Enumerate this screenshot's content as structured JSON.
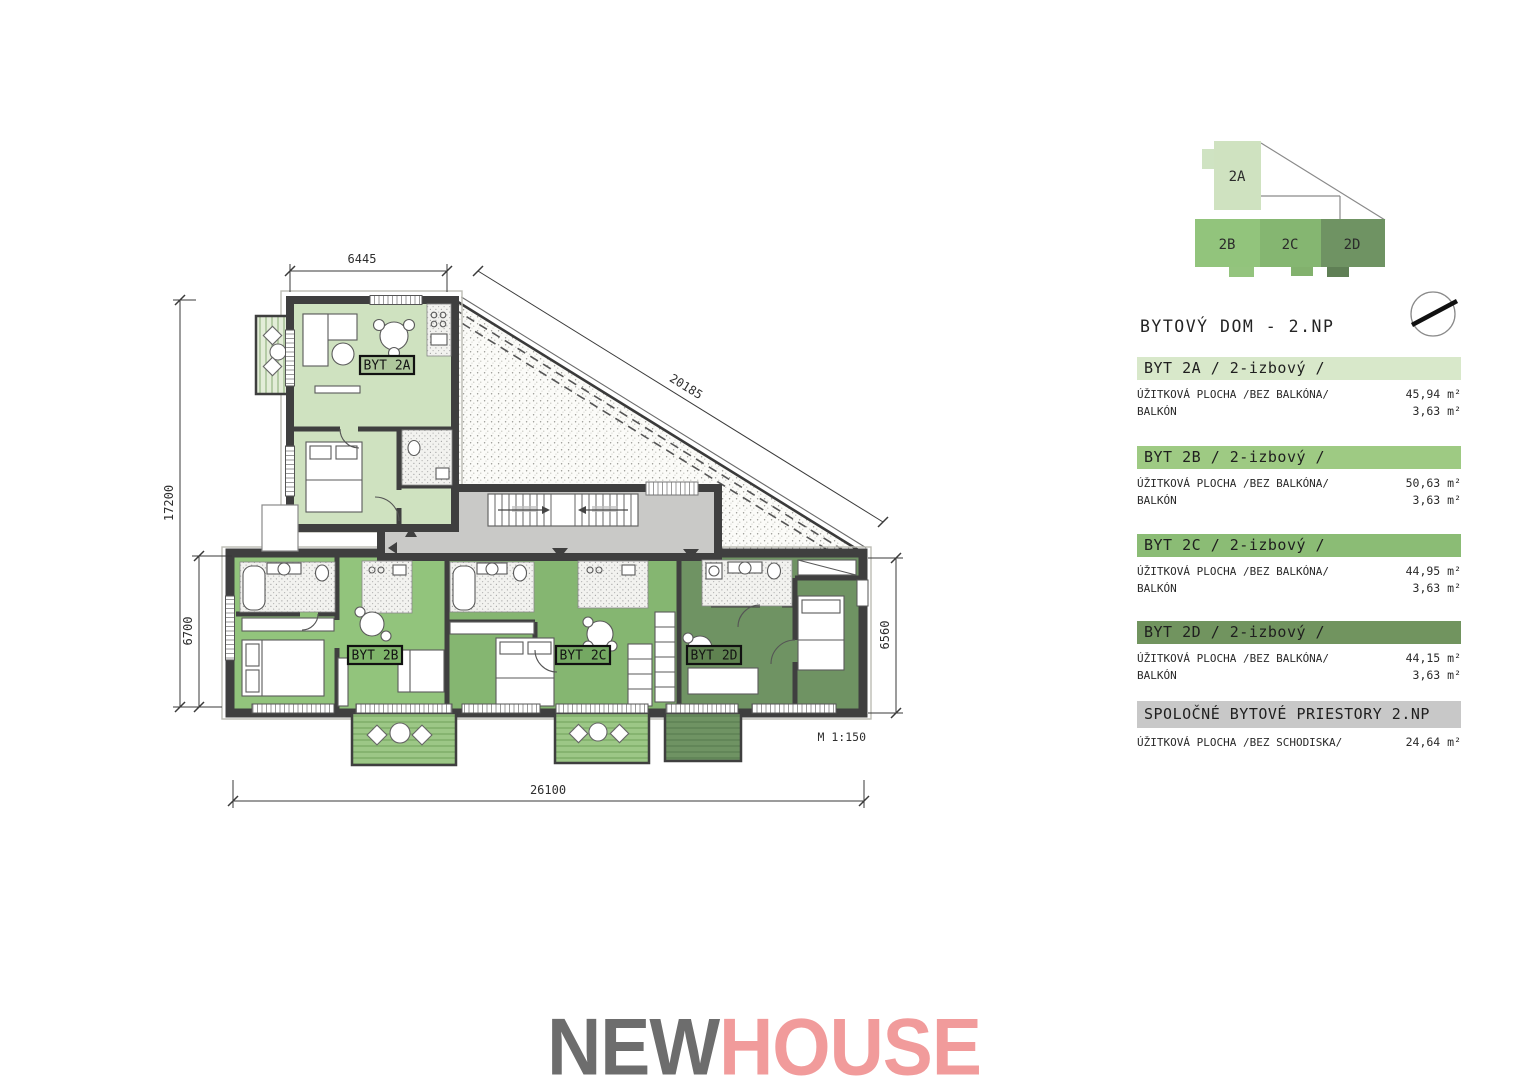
{
  "title": "BYTOVÝ DOM - 2.NP",
  "plan": {
    "scale_note": "M 1:150",
    "unit_labels": [
      {
        "text": "BYT 2A"
      },
      {
        "text": "BYT 2B"
      },
      {
        "text": "BYT 2C"
      },
      {
        "text": "BYT 2D"
      }
    ],
    "dimensions": {
      "top": "6445",
      "diagonal": "20185",
      "left_total": "17200",
      "left_lower": "6700",
      "bottom": "26100",
      "right": "6560"
    }
  },
  "minimap": {
    "blocks": [
      {
        "label": "2A"
      },
      {
        "label": "2B"
      },
      {
        "label": "2C"
      },
      {
        "label": "2D"
      }
    ]
  },
  "legend": {
    "entries": [
      {
        "header": "BYT 2A / 2-izbový /",
        "rows": [
          {
            "label": "ÚŽITKOVÁ PLOCHA /BEZ BALKÓNA/",
            "value": "45,94 m²"
          },
          {
            "label": "BALKÓN",
            "value": "3,63 m²"
          }
        ]
      },
      {
        "header": "BYT 2B / 2-izbový /",
        "rows": [
          {
            "label": "ÚŽITKOVÁ PLOCHA /BEZ BALKÓNA/",
            "value": "50,63 m²"
          },
          {
            "label": "BALKÓN",
            "value": "3,63 m²"
          }
        ]
      },
      {
        "header": "BYT 2C / 2-izbový /",
        "rows": [
          {
            "label": "ÚŽITKOVÁ PLOCHA /BEZ BALKÓNA/",
            "value": "44,95 m²"
          },
          {
            "label": "BALKÓN",
            "value": "3,63 m²"
          }
        ]
      },
      {
        "header": "BYT 2D / 2-izbový /",
        "rows": [
          {
            "label": "ÚŽITKOVÁ PLOCHA /BEZ BALKÓNA/",
            "value": "44,15 m²"
          },
          {
            "label": "BALKÓN",
            "value": "3,63 m²"
          }
        ]
      },
      {
        "header": "SPOLOČNÉ BYTOVÉ PRIESTORY 2.NP",
        "rows": [
          {
            "label": "ÚŽITKOVÁ PLOCHA /BEZ SCHODISKA/",
            "value": "24,64 m²"
          }
        ]
      }
    ]
  },
  "logo": {
    "new": "NEW",
    "house": "HOUSE"
  },
  "colors": {
    "apartment_2a": "#cfe2c0",
    "apartment_2b": "#92c47c",
    "apartment_2c": "#85b671",
    "apartment_2d": "#6f9363",
    "corridor": "#c9c9c7",
    "wall": "#3f3f3f",
    "legend_2a": "#d8e8ca",
    "legend_2b": "#9eca83",
    "legend_2c": "#8bbc75",
    "legend_2d": "#71945f",
    "legend_common": "#c8c8c8",
    "logo_new": "#6d6d6d",
    "logo_house": "#f19b9b"
  }
}
